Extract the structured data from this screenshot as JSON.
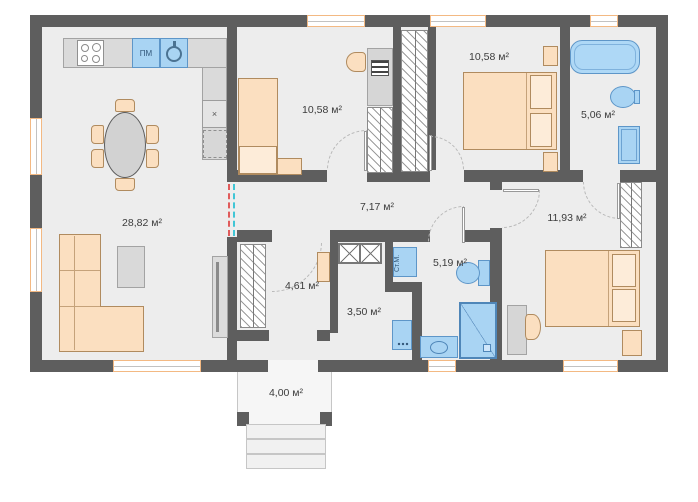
{
  "plan": {
    "labels": {
      "living": "28,82 м²",
      "bedroom1": "10,58 м²",
      "bedroom2": "10,58 м²",
      "bath_top": "5,06 м²",
      "corridor": "7,17 м²",
      "closet": "4,61 м²",
      "hall": "3,50 м²",
      "bath_bottom": "5,19 м²",
      "bedroom3": "11,93 м²",
      "porch": "4,00 м²"
    },
    "appliances": {
      "dishwasher": "ПМ",
      "washing_machine": "Ст.М.",
      "x_marker": "×"
    },
    "colors": {
      "wall": "#5e5e5e",
      "floor": "#ededed",
      "furniture_peach": "#fbdfc0",
      "fixture_blue": "#a9d4f3",
      "window_frame": "#f3b983"
    }
  }
}
